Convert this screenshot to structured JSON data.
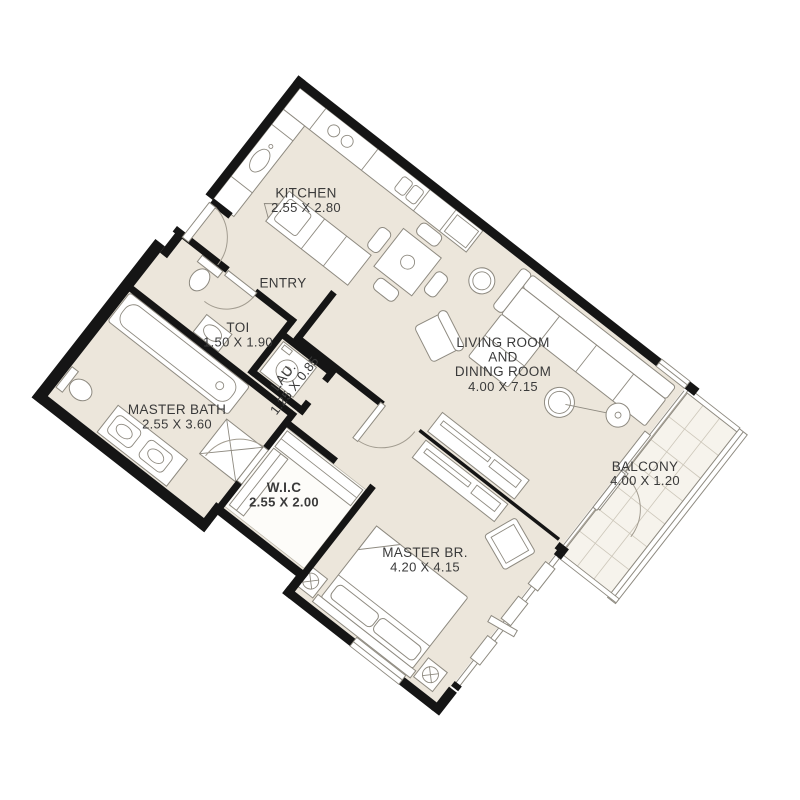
{
  "title": "Apartment floor plan",
  "colors": {
    "background": "#ffffff",
    "floor": "#ece6db",
    "balcony_floor": "#f6f3ec",
    "wall": "#151515",
    "furniture_stroke": "#8e8a80",
    "grid": "#cdc7ba",
    "label": "#3a3a3a"
  },
  "rooms": [
    {
      "id": "kitchen",
      "label": "KITCHEN",
      "dims": "2.55 X 2.80"
    },
    {
      "id": "entry",
      "label": "ENTRY",
      "dims": ""
    },
    {
      "id": "toi",
      "label": "TOI",
      "dims": "1.50 X 1.90"
    },
    {
      "id": "laundry",
      "label": "LAU.",
      "dims": "1.25 X 0.85"
    },
    {
      "id": "master-bath",
      "label": "MASTER BATH",
      "dims": "2.55 X 3.60"
    },
    {
      "id": "wic",
      "label": "W.I.C",
      "dims": "2.55 X 2.00"
    },
    {
      "id": "living-dining",
      "label_lines": [
        "LIVING ROOM",
        "AND",
        "DINING ROOM"
      ],
      "dims": "4.00 X 7.15"
    },
    {
      "id": "master-bedroom",
      "label": "MASTER BR.",
      "dims": "4.20 X 4.15"
    },
    {
      "id": "balcony",
      "label": "BALCONY",
      "dims": "4.00 X 1.20"
    }
  ]
}
